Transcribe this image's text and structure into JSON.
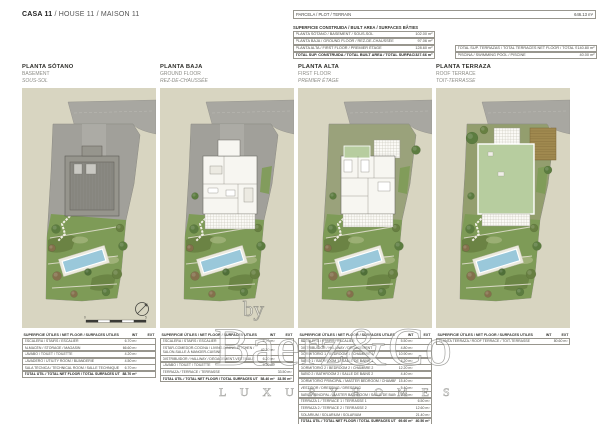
{
  "title": {
    "casa": "CASA 11",
    "rest": " / HOUSE 11 / MAISON 11"
  },
  "top": {
    "parcela_label": "PARCELA / PLOT / TERRAIN",
    "parcela_value": "646.13 m²",
    "built_header": "SUPERFICIE CONSTRUIDA / BUILT AREA / SURFACES BÂTIES",
    "built_rows": [
      {
        "label": "PLANTA SÓTANO / BASEMENT / SOUS-SOL",
        "value": "102.00 m²",
        "bold": false
      },
      {
        "label": "PLANTA BAJA / GROUND FLOOR / REZ-DE-CHAUSSÉE",
        "value": "97.06 m²",
        "bold": false
      },
      {
        "label": "PLANTA ALTA / FIRST FLOOR / PREMIER ÉTAGE",
        "value": "128.60 m²",
        "bold": false
      },
      {
        "label": "TOTAL SUP. CONSTRUIDA / TOTAL BUILT AREA / TOTAL SURFACES BÂTIES",
        "value": "327.66 m²",
        "bold": true
      }
    ],
    "side_rows": [
      {
        "label": "TOTAL SUP. TERRAZAS / TOTAL TERRACES NET FLOOR / TOTAL SURFACES UTILES TERRASSES",
        "value": "140.80 m²",
        "bold": false
      },
      {
        "label": "PISCINA / SWIMMING POOL / PISCINE",
        "value": "40.00 m²",
        "bold": false
      }
    ]
  },
  "floors": [
    {
      "name_es": "PLANTA SÓTANO",
      "name_en": "BASEMENT",
      "name_fr": "SOUS-SOL",
      "table": {
        "header": "SUPERFICIE ÚTILES / NET FLOOR / SURFACES UTILES",
        "int": "INT",
        "ext": "EXT",
        "rows": [
          {
            "label": "ESCALERA / STAIRS / ESCALIER",
            "int": "6.70 m²",
            "ext": "",
            "bold": false
          },
          {
            "label": "ALMACÉN / STORAGE / MAGASIN",
            "int": "66.60 m²",
            "ext": "",
            "bold": false
          },
          {
            "label": "LAVABO / TOILET / TOILETTE",
            "int": "4.20 m²",
            "ext": "",
            "bold": false
          },
          {
            "label": "LAVADERO / UTILITY ROOM / BUANDERIE",
            "int": "4.50 m²",
            "ext": "",
            "bold": false
          },
          {
            "label": "SALA TÉCNICA / TECHNICAL ROOM / SALLE TECHNIQUE",
            "int": "6.70 m²",
            "ext": "",
            "bold": false
          },
          {
            "label": "TOTAL ÚTIL / TOTAL NET FLOOR / TOTAL SURFACES UTILES",
            "int": "88.70 m²",
            "ext": "",
            "bold": true
          }
        ]
      }
    },
    {
      "name_es": "PLANTA BAJA",
      "name_en": "GROUND FLOOR",
      "name_fr": "REZ-DE-CHAUSSÉE",
      "table": {
        "header": "SUPERFICIE ÚTILES / NET FLOOR / SURFACES UTILES",
        "int": "INT",
        "ext": "EXT",
        "rows": [
          {
            "label": "ESCALERA / STAIRS / ESCALIER",
            "int": "6.70 m²",
            "ext": "",
            "bold": false
          },
          {
            "label": "ESTAR-COMEDOR-COCINA / LIVING-DINING-KITCHEN / SALON-SALLE À MANGER-CUISINE",
            "int": "42.30 m²",
            "ext": "",
            "bold": false
          },
          {
            "label": "DISTRIBUIDOR / HALLWAY / DÉGAGEMENT-VESTIBULE",
            "int": "6.20 m²",
            "ext": "",
            "bold": false
          },
          {
            "label": "LAVABO / TOILET / TOILETTE",
            "int": "3.20 m²",
            "ext": "",
            "bold": false
          },
          {
            "label": "TERRAZA / TERRACE / TERRASSE",
            "int": "",
            "ext": "33.50 m²",
            "bold": false
          },
          {
            "label": "TOTAL ÚTIL / TOTAL NET FLOOR / TOTAL SURFACES UTILES",
            "int": "58.40 m²",
            "ext": "33.50 m²",
            "bold": true
          }
        ]
      }
    },
    {
      "name_es": "PLANTA ALTA",
      "name_en": "FIRST FLOOR",
      "name_fr": "PREMIER ÉTAGE",
      "table": {
        "header": "SUPERFICIE ÚTILES / NET FLOOR / SURFACES UTILES",
        "int": "INT",
        "ext": "EXT",
        "rows": [
          {
            "label": "ESCALERA / STAIRS / ESCALIER",
            "int": "5.50 m²",
            "ext": "",
            "bold": false
          },
          {
            "label": "DISTRIBUIDOR / HALLWAY / DÉGAGEMENT",
            "int": "4.80 m²",
            "ext": "",
            "bold": false
          },
          {
            "label": "DORMITORIO 1 / BEDROOM 1 / CHAMBRE 1",
            "int": "10.90 m²",
            "ext": "",
            "bold": false
          },
          {
            "label": "BAÑO 1 / BATHROOM 1 / SALLE DE BAINS 1",
            "int": "4.20 m²",
            "ext": "",
            "bold": false
          },
          {
            "label": "DORMITORIO 2 / BEDROOM 2 / CHAMBRE 2",
            "int": "12.20 m²",
            "ext": "",
            "bold": false
          },
          {
            "label": "BAÑO 2 / BATHROOM 2 / SALLE DE BAINS 2",
            "int": "4.40 m²",
            "ext": "",
            "bold": false
          },
          {
            "label": "DORMITORIO PRINCIPAL / MASTER BEDROOM / CHAMBRE PRINCIPALE",
            "int": "15.40 m²",
            "ext": "",
            "bold": false
          },
          {
            "label": "VESTIDOR / DRESSING / DRESSING",
            "int": "5.40 m²",
            "ext": "",
            "bold": false
          },
          {
            "label": "BAÑO PRINCIPAL / MASTER BATHROOM / SALLE DE BAINS PRINCIPALE",
            "int": "6.80 m²",
            "ext": "",
            "bold": false
          },
          {
            "label": "TERRAZA 1 / TERRACE 1 / TERRASSE 1",
            "int": "",
            "ext": "6.50 m²",
            "bold": false
          },
          {
            "label": "TERRAZA 2 / TERRACE 2 / TERRASSE 2",
            "int": "",
            "ext": "12.60 m²",
            "bold": false
          },
          {
            "label": "SOLÁRIUM / SOLARIUM / SOLARIUM",
            "int": "",
            "ext": "21.40 m²",
            "bold": false
          },
          {
            "label": "TOTAL ÚTIL / TOTAL NET FLOOR / TOTAL SURFACES UTILES",
            "int": "69.60 m²",
            "ext": "40.50 m²",
            "bold": true
          }
        ]
      }
    },
    {
      "name_es": "PLANTA TERRAZA",
      "name_en": "ROOF TERRACE",
      "name_fr": "TOIT-TERRASSE",
      "table": {
        "header": "SUPERFICIE ÚTILES / NET FLOOR / SURFACES UTILES",
        "int": "INT",
        "ext": "EXT",
        "rows": [
          {
            "label": "PLANTA TERRAZA / ROOF TERRACE / TOIT-TERRASSE",
            "int": "",
            "ext": "80.60 m²",
            "bold": false
          }
        ]
      }
    }
  ],
  "watermark": {
    "by": "by",
    "name": "Baerz&Co",
    "tagline": "L U X U R Y   H O M E S"
  },
  "scale_bar": {
    "zero": "0",
    "five": "5"
  },
  "colors": {
    "panel": "#d8d5c1",
    "street": "#a8a7a1",
    "plot_gray": "#a1a09a",
    "plot_olive": "#939e6e",
    "plot_mixed": "#9aa27b",
    "garden": "#7e9b57",
    "garden_dark": "#677f41",
    "garden_light": "#a3b47c",
    "pool_blue": "#9ac8da",
    "pool_deck": "#eceade",
    "house_gray": "#96958d",
    "house_white": "#f7f6f1",
    "roof_green": "#b7cd9f",
    "deck_brown": "#a0894f",
    "tree_green": "#5c7c40",
    "tree_dark": "#4f6f38",
    "tree_brown": "#84704c"
  }
}
